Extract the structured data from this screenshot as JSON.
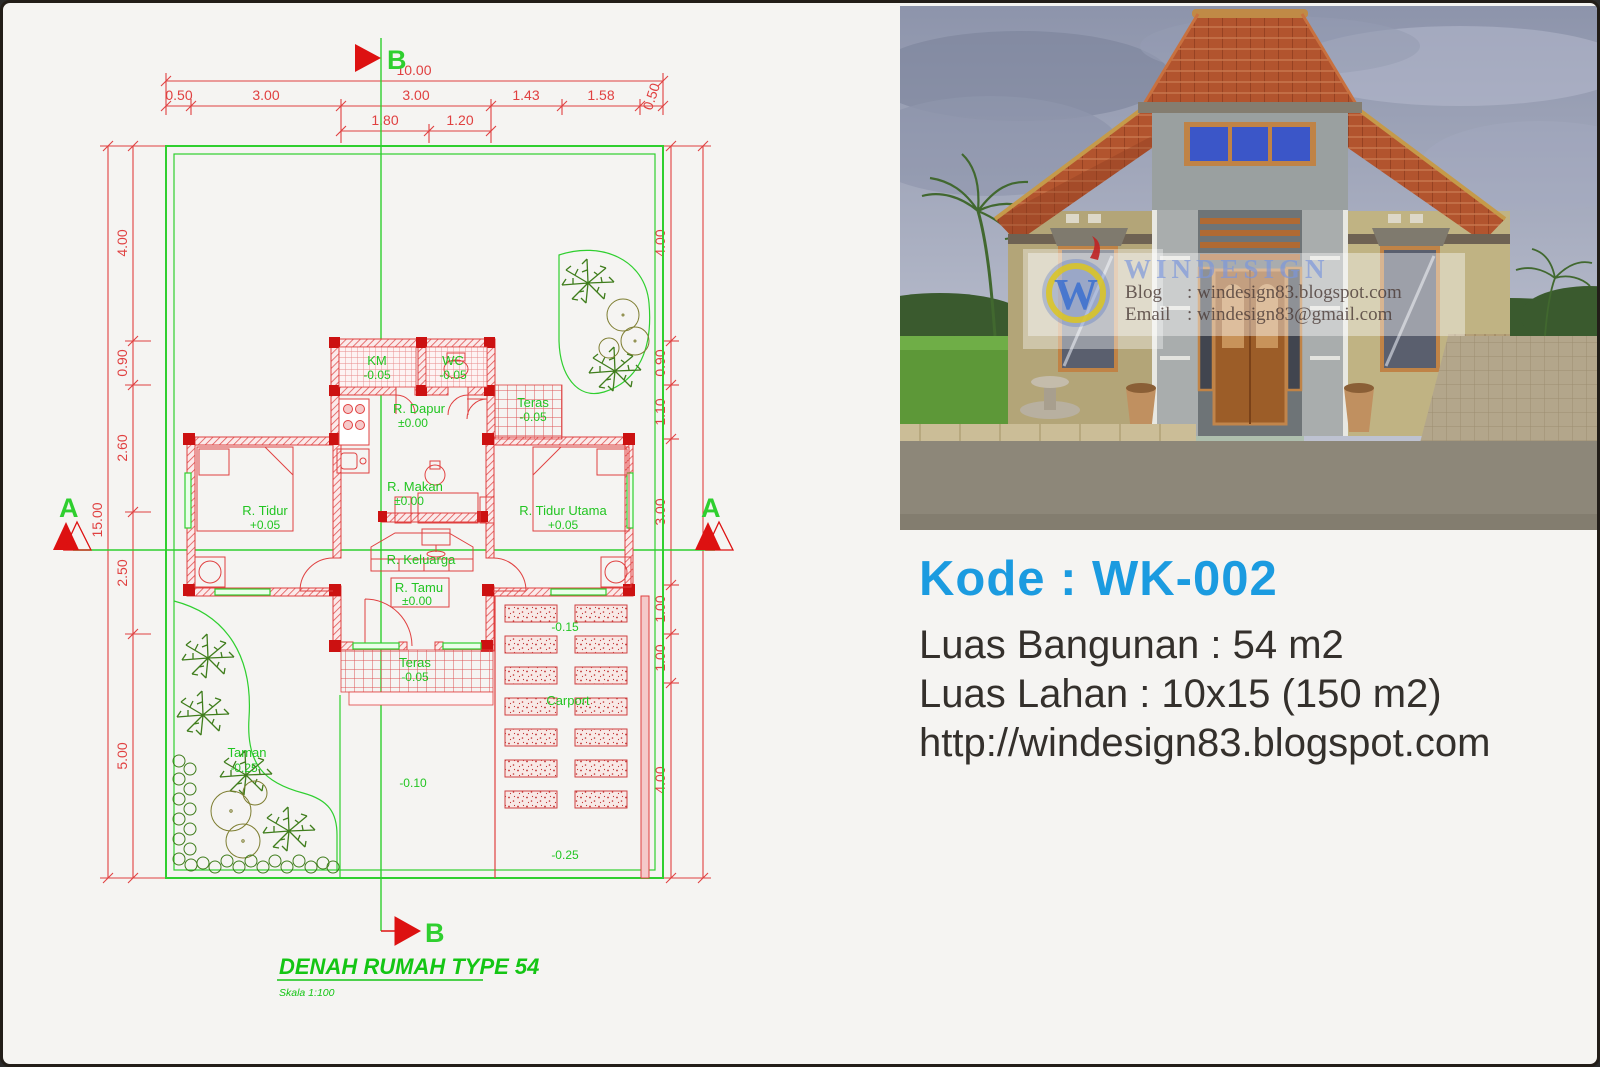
{
  "info": {
    "kode": "Kode : WK-002",
    "line1": "Luas Bangunan : 54 m2",
    "line2": "Luas Lahan : 10x15 (150 m2)",
    "line3": "http://windesign83.blogspot.com",
    "kode_color": "#1b9be0"
  },
  "plan": {
    "title": "DENAH RUMAH TYPE 54",
    "scale": "Skala 1:100",
    "sections": {
      "a": "A",
      "b": "B"
    },
    "dims": {
      "top_overall": "10.00",
      "top_chain": [
        "0.50",
        "3.00",
        "3.00",
        "1.43",
        "1.58",
        "0.50"
      ],
      "top_sub": [
        "1.80",
        "1.20"
      ],
      "left_overall": "15.00",
      "left_chain": [
        "4.00",
        "0.90",
        "2.60",
        "2.50",
        "5.00"
      ],
      "right_chain": [
        "4.00",
        "0.90",
        "1.10",
        "3.00",
        "1.00",
        "1.00",
        "4.00"
      ]
    },
    "rooms": {
      "km": {
        "name": "KM",
        "level": "-0.05"
      },
      "wc": {
        "name": "WC",
        "level": "-0.05"
      },
      "dapur": {
        "name": "R. Dapur",
        "level": "±0.00"
      },
      "teras_samping": {
        "name": "Teras",
        "level": "-0.05"
      },
      "tidur": {
        "name": "R. Tidur",
        "level": "+0.05"
      },
      "makan": {
        "name": "R. Makan",
        "level": "±0.00"
      },
      "tidur_utama": {
        "name": "R. Tidur Utama",
        "level": "+0.05"
      },
      "keluarga": {
        "name": "R. Keluarga"
      },
      "tamu": {
        "name": "R. Tamu",
        "level": "±0.00"
      },
      "teras_depan": {
        "name": "Teras",
        "level": "-0.05"
      },
      "taman": {
        "name": "Taman",
        "level": "-0.25"
      },
      "carport": {
        "name": "Carport"
      }
    },
    "levels": {
      "carport_upper": "-0.15",
      "walkway": "-0.10",
      "carport_lower": "-0.25"
    }
  },
  "photo": {
    "watermark": {
      "logo_letter": "W",
      "brand": "WINDESIGN",
      "blog_label": "Blog",
      "blog_value": ": windesign83.blogspot.com",
      "email_label": "Email",
      "email_value": ": windesign83@gmail.com"
    }
  },
  "colors": {
    "cad_red": "#e04040",
    "cad_green": "#2fcf2f",
    "accent_blue": "#1b9be0"
  }
}
